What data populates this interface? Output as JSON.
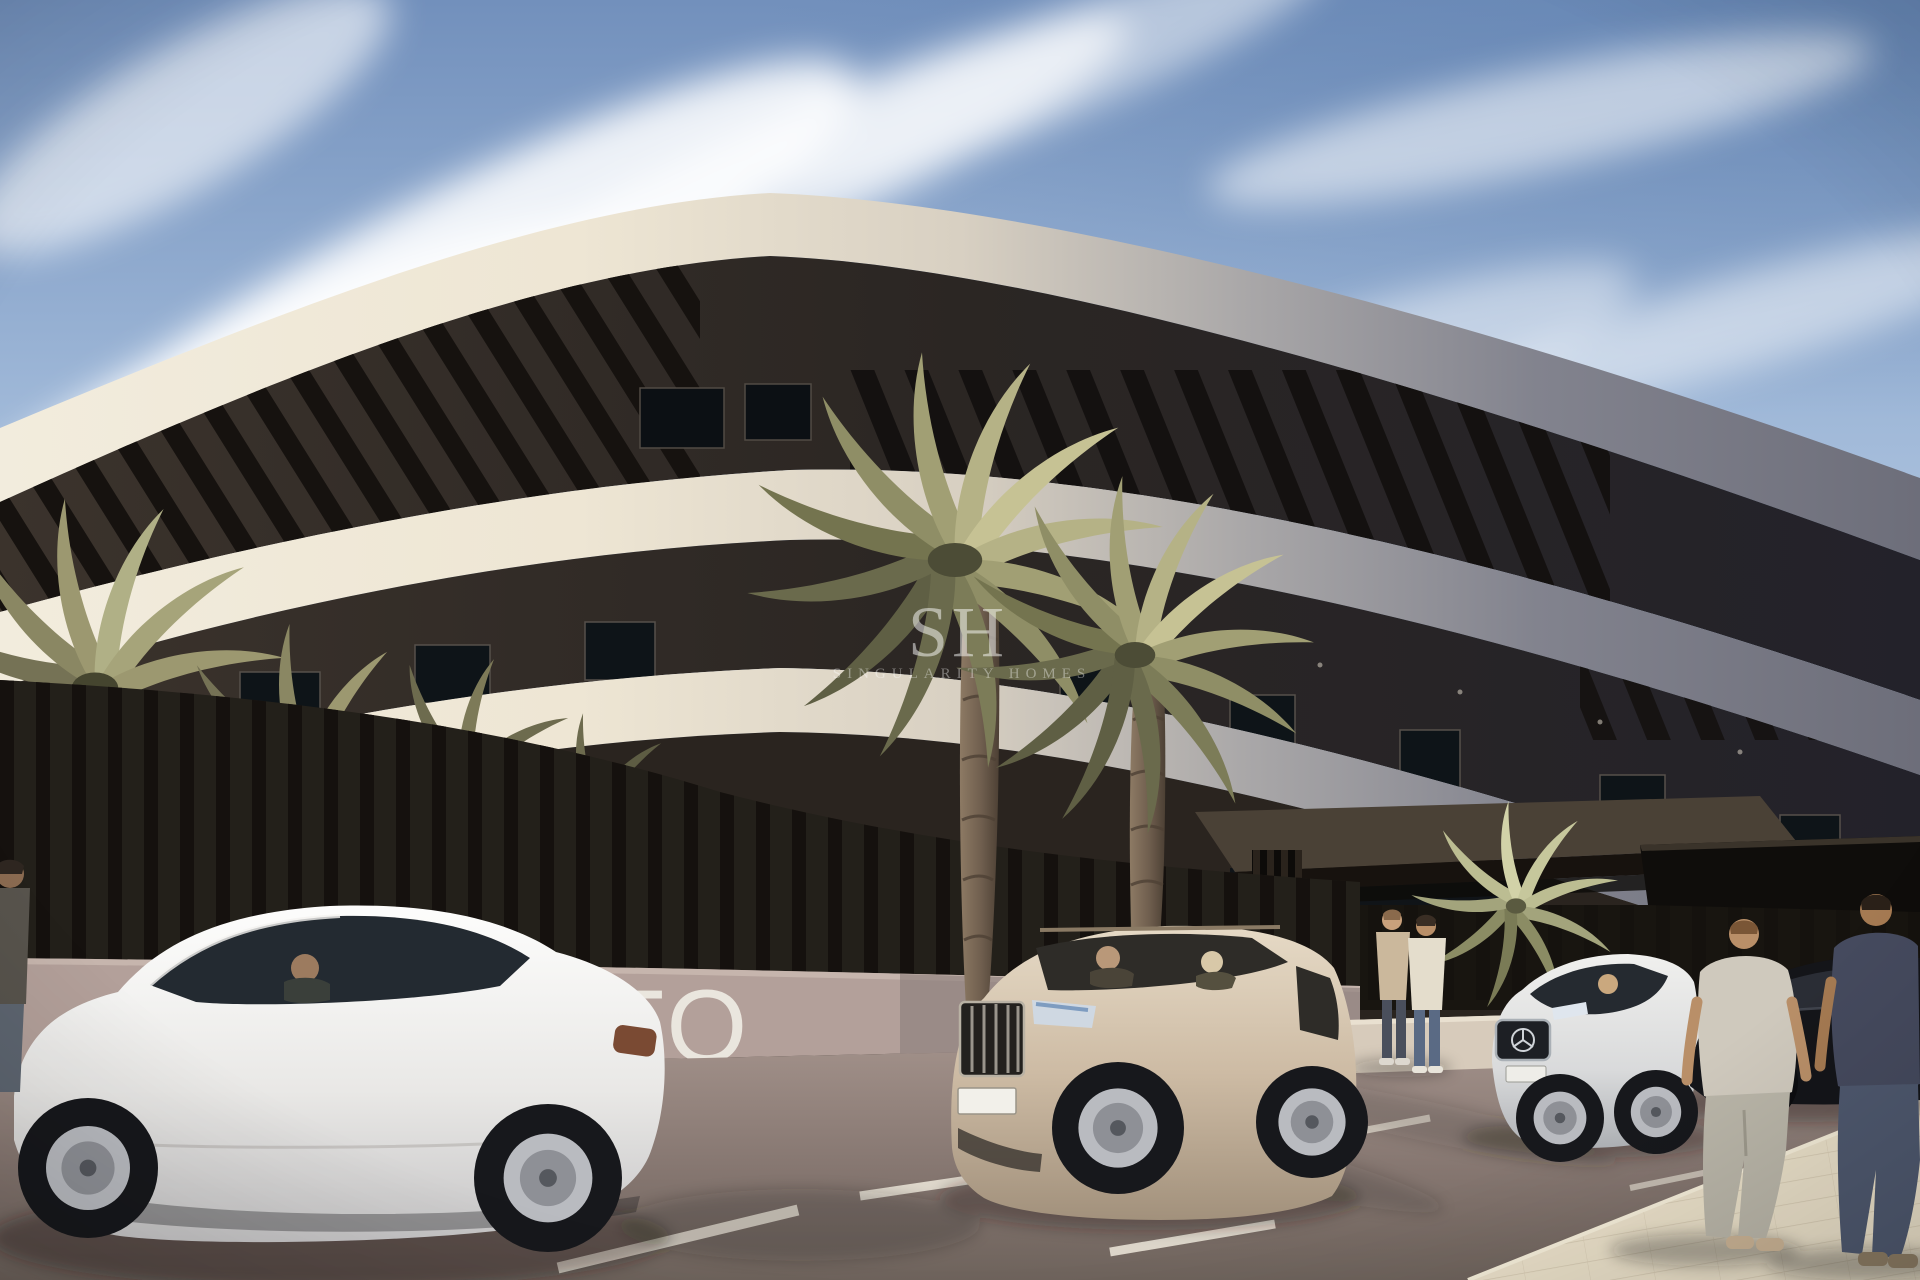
{
  "image": {
    "title": "New-build curved apartment complex — exterior street view render",
    "style": "photorealistic architectural visualization, sunny day"
  },
  "watermark": {
    "monogram": "SH",
    "caption": "SINGULARITY HOMES"
  },
  "signage": {
    "wall_letters": "TO"
  },
  "palette": {
    "sky_top": "#7290bc",
    "sky_horizon": "#e9ebee",
    "cloud": "#ffffff",
    "facade_sunlit": "#f2ecdd",
    "facade_shaded": "#6d6e7a",
    "recess_dark": "#2b2623",
    "pergola_dark": "#16120f",
    "palm_olive": "#8f8e66",
    "palm_light": "#c6c294",
    "trunk_brown": "#6f5e4e",
    "wall_mauve": "#b3a09a",
    "road_taupe": "#8a7a72",
    "sidewalk_cream": "#e9dfc8",
    "marking_white": "#efe9dc",
    "car_white": "#f4f4f4",
    "car_champagne": "#cdbba4",
    "car_black": "#141519"
  },
  "scene": {
    "objects": [
      "sky",
      "cirrus-clouds",
      "curved-apartment-building",
      "rooftop-pergola-slats",
      "balcony-bands",
      "entrance-canopy",
      "perimeter-slat-fence",
      "painted-wall-letters",
      "tall-palm-trees",
      "left-palm-group",
      "entrance-cycad-palm",
      "white-sedan-with-driver",
      "champagne-suv-with-passengers",
      "white-mercedes-sedan",
      "black-sedan",
      "man-cropped-at-left-edge",
      "two-men-talking-at-entrance",
      "two-men-walking-right",
      "asphalt-road",
      "white-parking-markings",
      "paved-sidewalk",
      "watermark"
    ]
  }
}
